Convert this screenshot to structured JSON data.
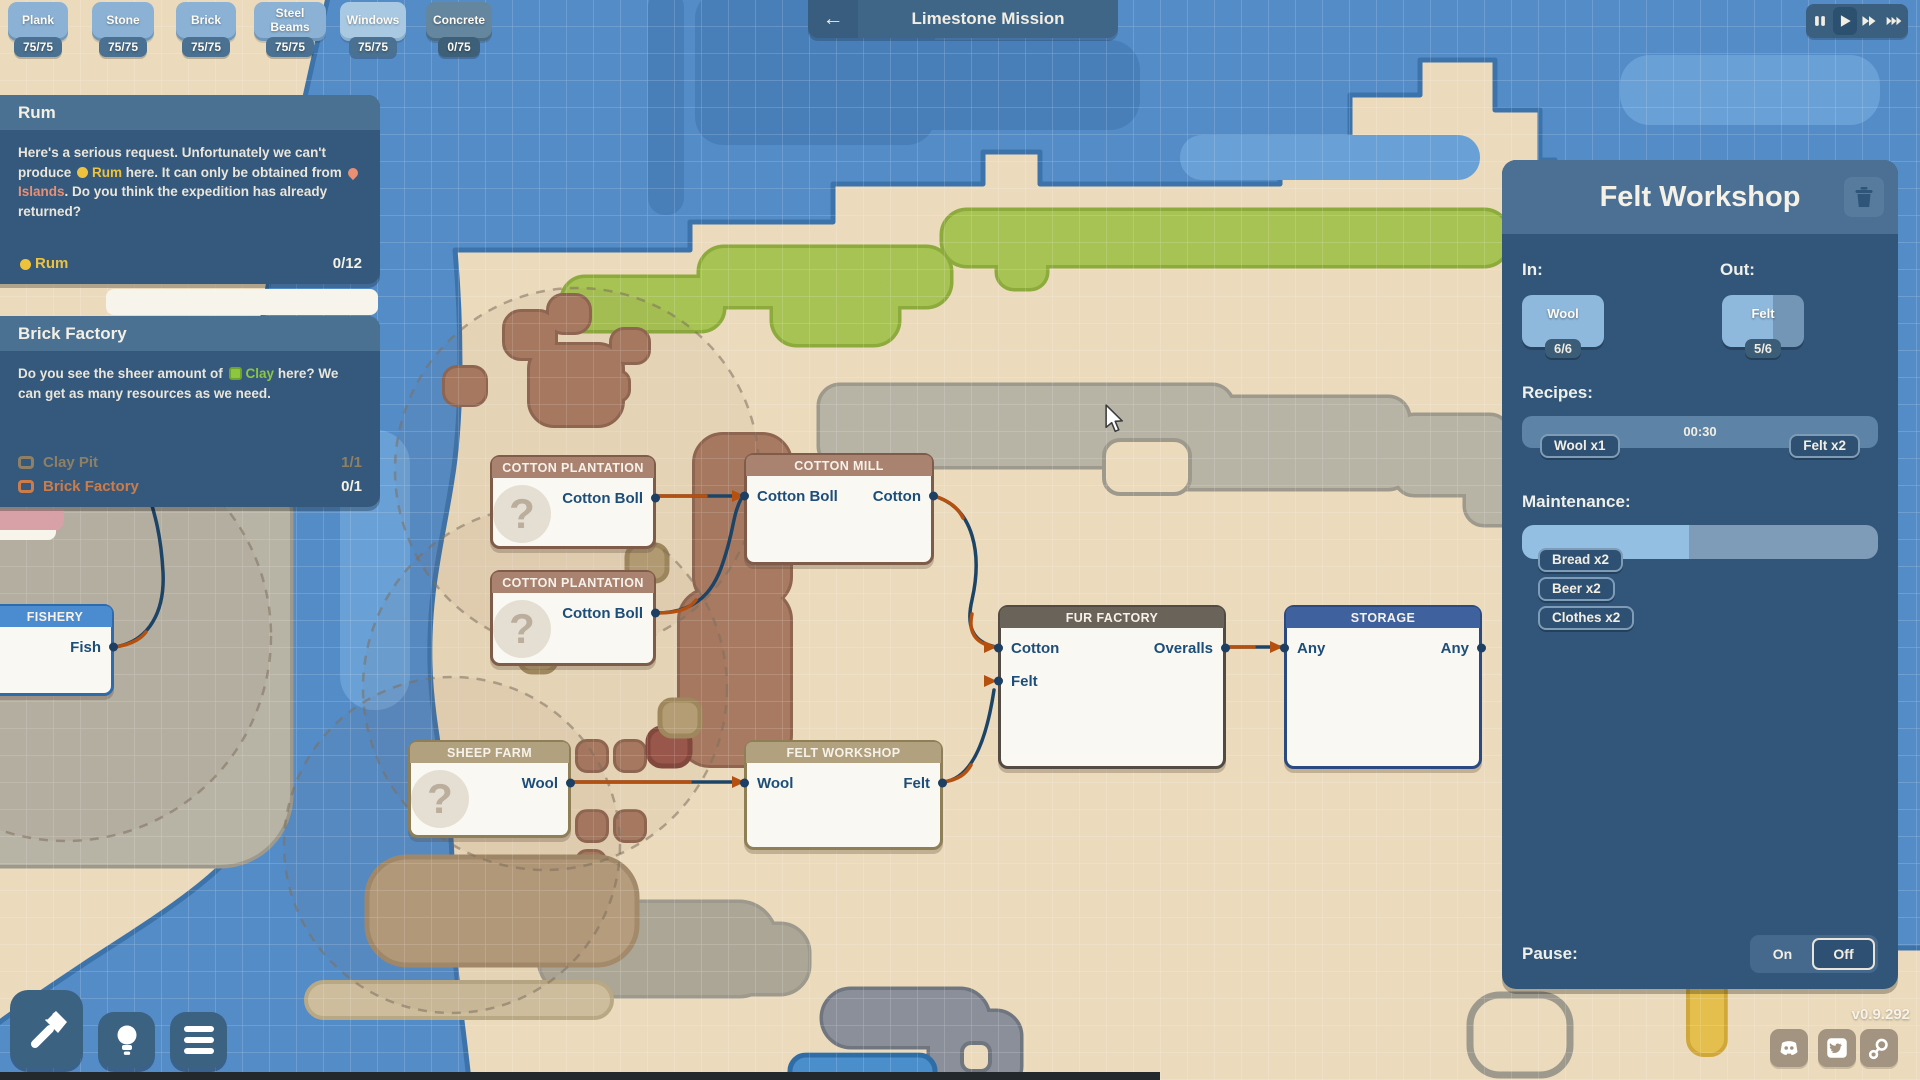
{
  "resources": [
    {
      "name": "Plank",
      "count": "75/75"
    },
    {
      "name": "Stone",
      "count": "75/75"
    },
    {
      "name": "Brick",
      "count": "75/75"
    },
    {
      "name": "Steel Beams",
      "count": "75/75"
    },
    {
      "name": "Windows",
      "count": "75/75"
    },
    {
      "name": "Concrete",
      "count": "0/75"
    }
  ],
  "top_bar": {
    "mission_title": "Limestone Mission",
    "back_icon": "arrow-left",
    "speed_icons": [
      "pause",
      "play",
      "fast-forward",
      "fastest"
    ]
  },
  "quest_cards": [
    {
      "title": "Rum",
      "body": {
        "s0": "Here's a serious request. Unfortunately we can't produce ",
        "s1": "Rum",
        "s2": " here. It can only be obtained from ",
        "s3": "Islands",
        "s4": ". Do you think the expedition has already returned?"
      },
      "objective": {
        "name": "Rum",
        "progress": "0/12"
      }
    },
    {
      "title": "Brick Factory",
      "body": {
        "s0": "Do you see the sheer amount of ",
        "s1": "Clay",
        "s2": " here? We can get as many resources as we need."
      },
      "items": [
        {
          "name": "Clay Pit",
          "progress": "1/1"
        },
        {
          "name": "Brick Factory",
          "progress": "0/1"
        }
      ]
    }
  ],
  "map_nodes": [
    {
      "title": "COTTON PLANTATION",
      "out": "Cotton Boll"
    },
    {
      "title": "COTTON MILL",
      "in": "Cotton Boll",
      "out": "Cotton"
    },
    {
      "title": "COTTON PLANTATION",
      "out": "Cotton Boll"
    },
    {
      "title": "FISHERY",
      "out": "Fish"
    },
    {
      "title": "SHEEP FARM",
      "out": "Wool"
    },
    {
      "title": "FELT WORKSHOP",
      "in": "Wool",
      "out": "Felt"
    },
    {
      "title": "FUR FACTORY",
      "in1": "Cotton",
      "in2": "Felt",
      "out": "Overalls"
    },
    {
      "title": "STORAGE",
      "in": "Any",
      "out": "Any"
    }
  ],
  "inspector": {
    "title": "Felt Workshop",
    "in_label": "In:",
    "out_label": "Out:",
    "input": {
      "name": "Wool",
      "count": "6/6"
    },
    "output": {
      "name": "Felt",
      "count": "5/6"
    },
    "recipes_label": "Recipes:",
    "recipe": {
      "duration": "00:30",
      "input": "Wool x1",
      "output": "Felt x2"
    },
    "maintenance_label": "Maintenance:",
    "maintenance_fill_style": "width:47%",
    "maintenance_items": [
      {
        "label": "Bread x2"
      },
      {
        "label": "Beer x2"
      },
      {
        "label": "Clothes x2"
      }
    ],
    "pause": {
      "label": "Pause:",
      "on": "On",
      "off": "Off",
      "selected": "Off"
    }
  },
  "footer": {
    "version": "v0.9.292"
  },
  "colors": {
    "accent_yellow": "#edc23d",
    "accent_salmon": "#e98f74",
    "accent_green": "#8dc63f",
    "accent_orange": "#cd7c49",
    "panel_blue": "#32567a",
    "panel_header": "#4b7094",
    "water": "#548cc8",
    "sand": "#ebdabb",
    "grass": "#a6c353"
  }
}
